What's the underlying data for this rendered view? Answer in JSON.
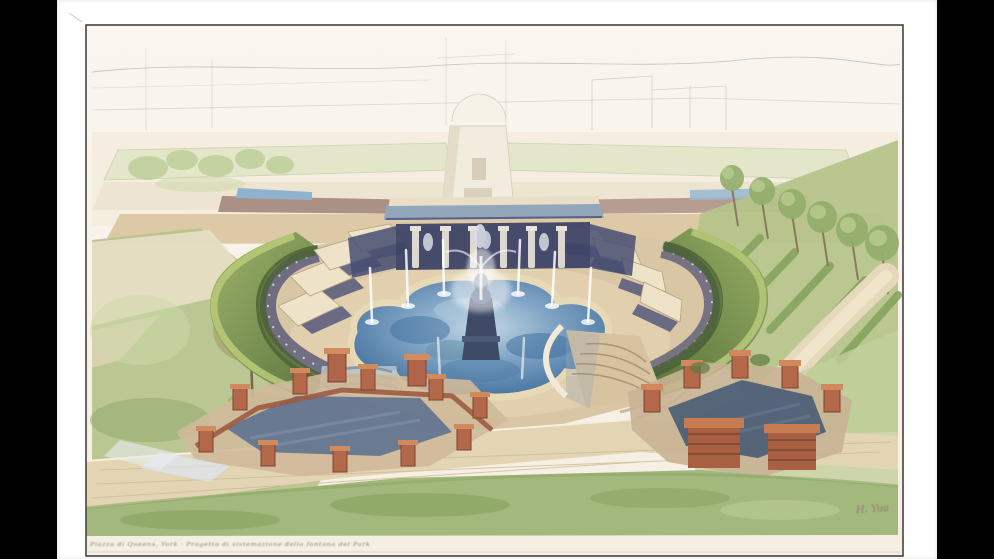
{
  "scene": {
    "alt_text": "Watercolor and pencil aerial perspective rendering of a formal garden plaza: an oval court enclosed by curved green hedge walls with cream canopied pavilions, a quatrefoil fountain pool with water jets and a central sculpture, a colonnade behind, brick parterre enclosures in the foreground, lawns, a small autumn tree at left and a row of trees on a slope at right, with a faintly sketched esplanade and buildings in the background.",
    "caption": "Piazza di Queens, York · Progetto di sistemazione della fontana del Park",
    "signature": "H. Yua"
  },
  "palette": {
    "letterbox": "#000000",
    "paper_margin": "#ffffff",
    "paper_ground": "#f8f2e8",
    "frame_line": "#46423e",
    "hedge_green": "#7d9455",
    "lawn_green": "#b3c48b",
    "water_blue": "#5580aa",
    "shadow_indigo": "#454a6e",
    "paving_tan": "#dcc9a8",
    "brick_red": "#b4684a",
    "canopy_cream": "#ece0c6"
  }
}
